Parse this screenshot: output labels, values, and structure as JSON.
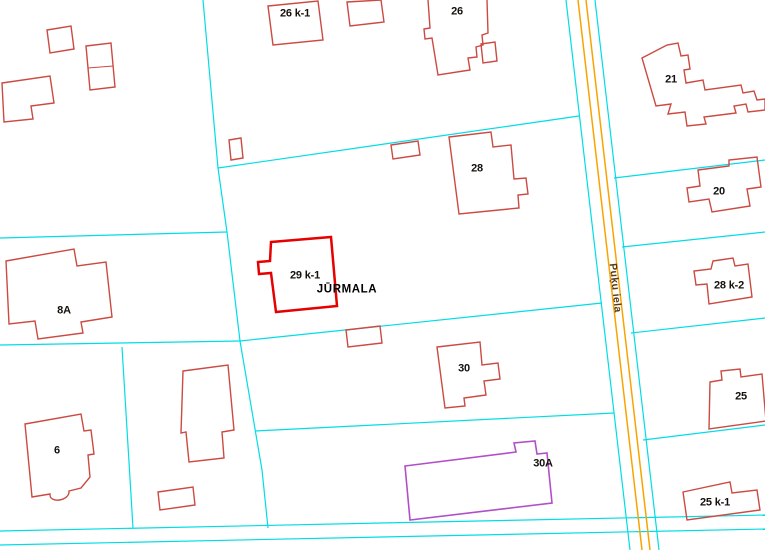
{
  "map": {
    "city_label": "JŪRMALA",
    "street_label": "Puķu iela",
    "colors": {
      "background": "#ffffff",
      "parcel_boundary": "#00dde6",
      "road_centerline": "#f8a400",
      "building_outline": "#cb4a42",
      "building_selected": "#e60000",
      "building_special": "#b14fc8",
      "label_text": "#16100c",
      "street_text": "#5c3a16"
    },
    "labels": [
      {
        "text": "26 k-1",
        "x": 295,
        "y": 14,
        "name": "label-building-26-k-1"
      },
      {
        "text": "26",
        "x": 457,
        "y": 12,
        "name": "label-building-26"
      },
      {
        "text": "21",
        "x": 671,
        "y": 80,
        "name": "label-building-21"
      },
      {
        "text": "28",
        "x": 477,
        "y": 169,
        "name": "label-building-28"
      },
      {
        "text": "20",
        "x": 719,
        "y": 192,
        "name": "label-building-20"
      },
      {
        "text": "29 k-1",
        "x": 305,
        "y": 276,
        "name": "label-building-29-k-1"
      },
      {
        "text": "JŪRMALA",
        "x": 347,
        "y": 290,
        "cls": "city",
        "name": "city-name-label"
      },
      {
        "text": "28 k-2",
        "x": 729,
        "y": 286,
        "name": "label-building-28-k-2"
      },
      {
        "text": "8A",
        "x": 64,
        "y": 311,
        "name": "label-building-8a"
      },
      {
        "text": "30",
        "x": 464,
        "y": 369,
        "name": "label-building-30"
      },
      {
        "text": "25",
        "x": 741,
        "y": 397,
        "name": "label-building-25"
      },
      {
        "text": "6",
        "x": 57,
        "y": 451,
        "name": "label-building-6"
      },
      {
        "text": "30A",
        "x": 543,
        "y": 464,
        "name": "label-building-30a"
      },
      {
        "text": "25 k-1",
        "x": 715,
        "y": 503,
        "name": "label-building-25-k-1"
      },
      {
        "text": "Puķu iela",
        "x": 615,
        "y": 288,
        "rot": 84,
        "cls": "street",
        "name": "street-name-label"
      }
    ],
    "parcel_lines": [
      {
        "points": "203,0 218,168 227,232 240,341 262,470 268,528"
      },
      {
        "points": "0,238 227,232"
      },
      {
        "points": "0,345 240,341"
      },
      {
        "points": "240,341 602,303"
      },
      {
        "points": "218,168 579,116"
      },
      {
        "points": "122,347 133,528"
      },
      {
        "points": "255,431 614,413"
      },
      {
        "points": "566,0 630,550"
      },
      {
        "points": "595,0 659,550"
      },
      {
        "points": "614,178 765,160"
      },
      {
        "points": "622,247 765,232"
      },
      {
        "points": "631,333 765,318"
      },
      {
        "points": "643,440 765,425"
      },
      {
        "points": "0,531 765,515"
      },
      {
        "points": "0,545 765,529"
      }
    ],
    "road_lines": [
      {
        "points": "578,0 642,550"
      },
      {
        "points": "586,0 650,550"
      }
    ],
    "buildings": [
      {
        "id": "house-a",
        "path": "M47,30 L71,26 L74,49 L50,53 Z"
      },
      {
        "id": "house-b",
        "path": "M86,46 L111,43 L115,87 L90,90 Z"
      },
      {
        "id": "house-b-wall",
        "path": "M88,68 L113,66",
        "type": "detail"
      },
      {
        "id": "house-c",
        "path": "M2,83 L50,76 L54,103 L31,106 L33,119 L4,122 Z"
      },
      {
        "id": "building-8a",
        "path": "M6,261 L74,249 L77,266 L106,262 L112,317 L81,322 L83,333 L38,339 L35,321 L9,324 Z"
      },
      {
        "id": "building-6",
        "path": "M25,424 L81,414 L84,431 L91,430 L94,454 L88,455 L90,477 L81,488 L69,491 C70,501 49,504 50,494 L32,497 Z"
      },
      {
        "id": "house-d",
        "path": "M183,371 L228,365 L234,430 L222,432 L224,458 L189,462 L186,432 L181,433 Z"
      },
      {
        "id": "house-e",
        "path": "M158,492 L193,487 L195,505 L160,510 Z"
      },
      {
        "id": "building-26-k-1",
        "path": "M268,6 L318,1 L323,40 L273,45 Z"
      },
      {
        "id": "house-f",
        "path": "M347,2 L381,0 L384,22 L350,26 Z"
      },
      {
        "id": "building-26",
        "path": "M428,0 L430,28 L424,29 L425,39 L432,38 L438,75 L470,70 L468,58 L477,57 L476,47 L483,45 L482,35 L488,33 L487,0"
      },
      {
        "id": "building-26-annex",
        "path": "M481,44 L495,42 L497,61 L483,63 Z"
      },
      {
        "id": "house-g",
        "path": "M229,140 L241,138 L243,158 L231,160 Z"
      },
      {
        "id": "house-h",
        "path": "M391,145 L418,141 L420,155 L393,159 Z"
      },
      {
        "id": "building-28",
        "path": "M449,137 L491,132 L493,147 L511,145 L514,179 L526,178 L528,194 L518,195 L519,208 L459,214 Z"
      },
      {
        "id": "building-29-k-1",
        "path": "M271,242 L331,237 L337,306 L276,312 L271,273 L259,274 L258,262 L270,261 Z",
        "type": "selected"
      },
      {
        "id": "house-i",
        "path": "M346,330 L380,326 L382,343 L348,347 Z"
      },
      {
        "id": "building-30",
        "path": "M437,347 L480,342 L482,365 L498,363 L500,379 L484,381 L486,395 L464,398 L465,406 L445,408 Z"
      },
      {
        "id": "building-30a",
        "path": "M405,466 L516,452 L514,443 L535,441 L537,454 L547,453 L552,503 L410,520 Z",
        "type": "special"
      },
      {
        "id": "building-21",
        "path": "M642,58 L667,45 L678,43 L681,56 L688,55 L690,69 L684,70 L686,83 L703,80 L705,90 L741,85 L743,93 L754,91 L757,100 L765,99 L765,110 L748,112 L746,104 L734,106 L736,113 L704,117 L706,124 L687,126 L685,112 L668,114 L671,104 L656,106 Z"
      },
      {
        "id": "building-20",
        "path": "M698,170 L729,166 L729,160 L757,157 L761,187 L747,189 L750,206 L712,212 L709,199 L689,202 L687,188 L700,186 Z"
      },
      {
        "id": "building-28-k-2",
        "path": "M713,261 L733,258 L735,266 L748,264 L752,297 L709,304 L707,284 L696,285 L694,271 L711,269 Z"
      },
      {
        "id": "building-25",
        "path": "M710,382 L722,380 L721,371 L740,369 L741,377 L762,374 L766,421 L709,429 Z"
      },
      {
        "id": "building-25-k-1",
        "path": "M683,492 L730,482 L732,493 L757,490 L760,510 L687,520 Z"
      }
    ]
  }
}
